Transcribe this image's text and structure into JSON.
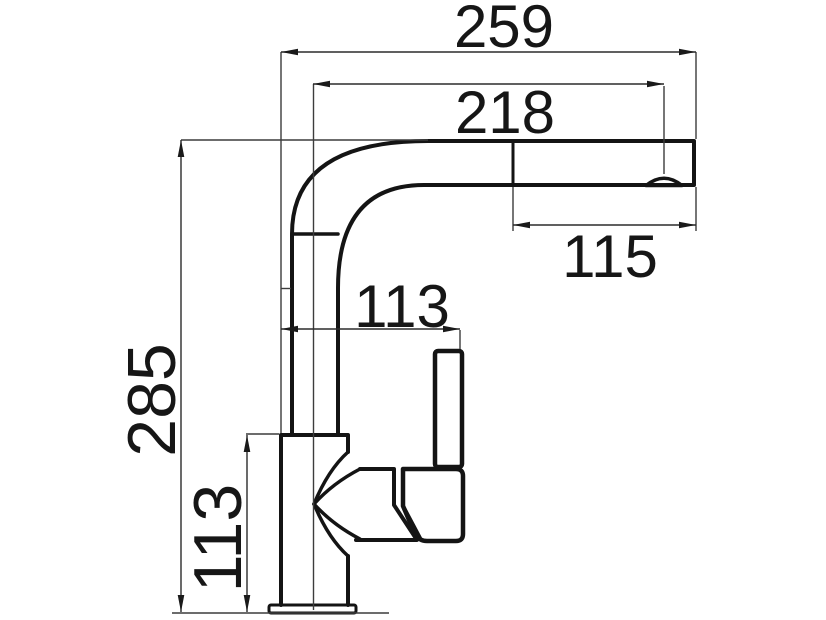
{
  "drawing": {
    "type": "technical-dimension-drawing",
    "subject": "kitchen-faucet-side-elevation",
    "background_color": "#ffffff",
    "line_color": "#1a1a1a",
    "dimensions": {
      "overall_reach": {
        "value": "259",
        "orientation": "horizontal",
        "position": "top"
      },
      "spout_reach": {
        "value": "218",
        "orientation": "horizontal",
        "position": "below-top"
      },
      "spray_head_length": {
        "value": "115",
        "orientation": "horizontal",
        "position": "under-spout"
      },
      "handle_projection": {
        "value": "113",
        "orientation": "horizontal",
        "position": "middle"
      },
      "overall_height": {
        "value": "285",
        "orientation": "vertical",
        "position": "left"
      },
      "body_height": {
        "value": "113",
        "orientation": "vertical",
        "position": "lower-left"
      }
    }
  }
}
